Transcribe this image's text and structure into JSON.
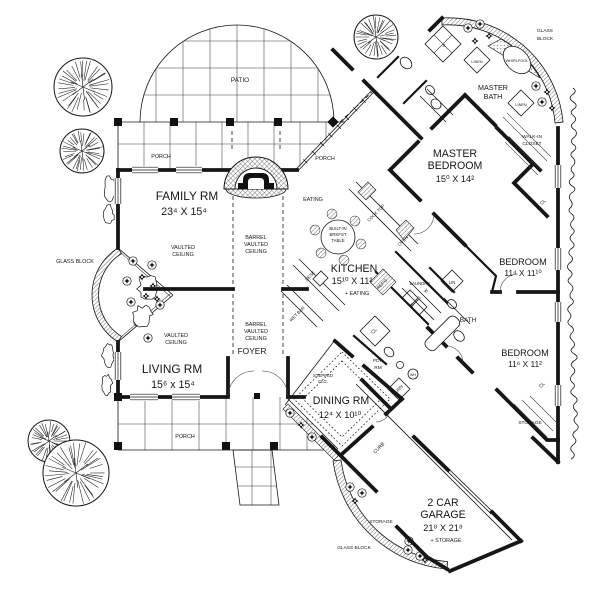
{
  "plan": {
    "rooms": {
      "family": {
        "name": "FAMILY RM",
        "dims": "23⁴ X 15⁴"
      },
      "living": {
        "name": "LIVING RM",
        "dims": "15⁶ x 15⁴"
      },
      "kitchen": {
        "name": "KITCHEN",
        "dims": "15¹⁰ X 11²",
        "note": "+ EATING"
      },
      "dining": {
        "name": "DINING RM",
        "dims": "12⁴ X 10¹⁰"
      },
      "master": {
        "line1": "MASTER",
        "line2": "BEDROOM",
        "dims": "15⁰ X 14²"
      },
      "bedroom1": {
        "name": "BEDROOM",
        "dims": "11⁴ X 11¹⁰"
      },
      "bedroom2": {
        "name": "BEDROOM",
        "dims": "11⁶ X 11²"
      },
      "garage": {
        "line1": "2 CAR",
        "line2": "GARAGE",
        "dims": "21⁸ X 21⁸",
        "note": "+ STORAGE"
      }
    },
    "labels": {
      "patio": "PATIO",
      "porch": "PORCH",
      "eating": "EATING",
      "vaulted_1": "VAULTED",
      "vaulted_2": "CEILING",
      "barrel_1": "BARREL",
      "barrel_2": "VAULTED",
      "barrel_3": "CEILING",
      "glass_block": "GLASS BLOCK",
      "glass_1": "GLASS",
      "glass_2": "BLOCK",
      "master_bath_1": "MASTER",
      "master_bath_2": "BATH",
      "walkin_1": "WALK-IN",
      "walkin_2": "CLOSET",
      "linen": "LINEN",
      "whirlpool": "WHIRLPOOL",
      "shower_s": "S",
      "bath": "BATH",
      "laundry": "LAUNDRY",
      "lin": "LIN",
      "cl": "CL",
      "storage": "STORAGE",
      "foyer": "FOYER",
      "stepped_1": "STEPPED",
      "stepped_2": "CLG.",
      "pdr_1": "PDR",
      "pdr_2": "RM",
      "furn": "FURN",
      "wh": "WH",
      "curb": "CURB",
      "cook_top": "COOK TOP",
      "oven": "OVEN",
      "desk": "DESK",
      "wet_bar": "WET BAR",
      "refg": "REF'G",
      "brk_1": "BUILT-IN",
      "brk_2": "BRKFST",
      "brk_3": "TABLE",
      "d": "D",
      "s": "S",
      "w": "W"
    }
  }
}
